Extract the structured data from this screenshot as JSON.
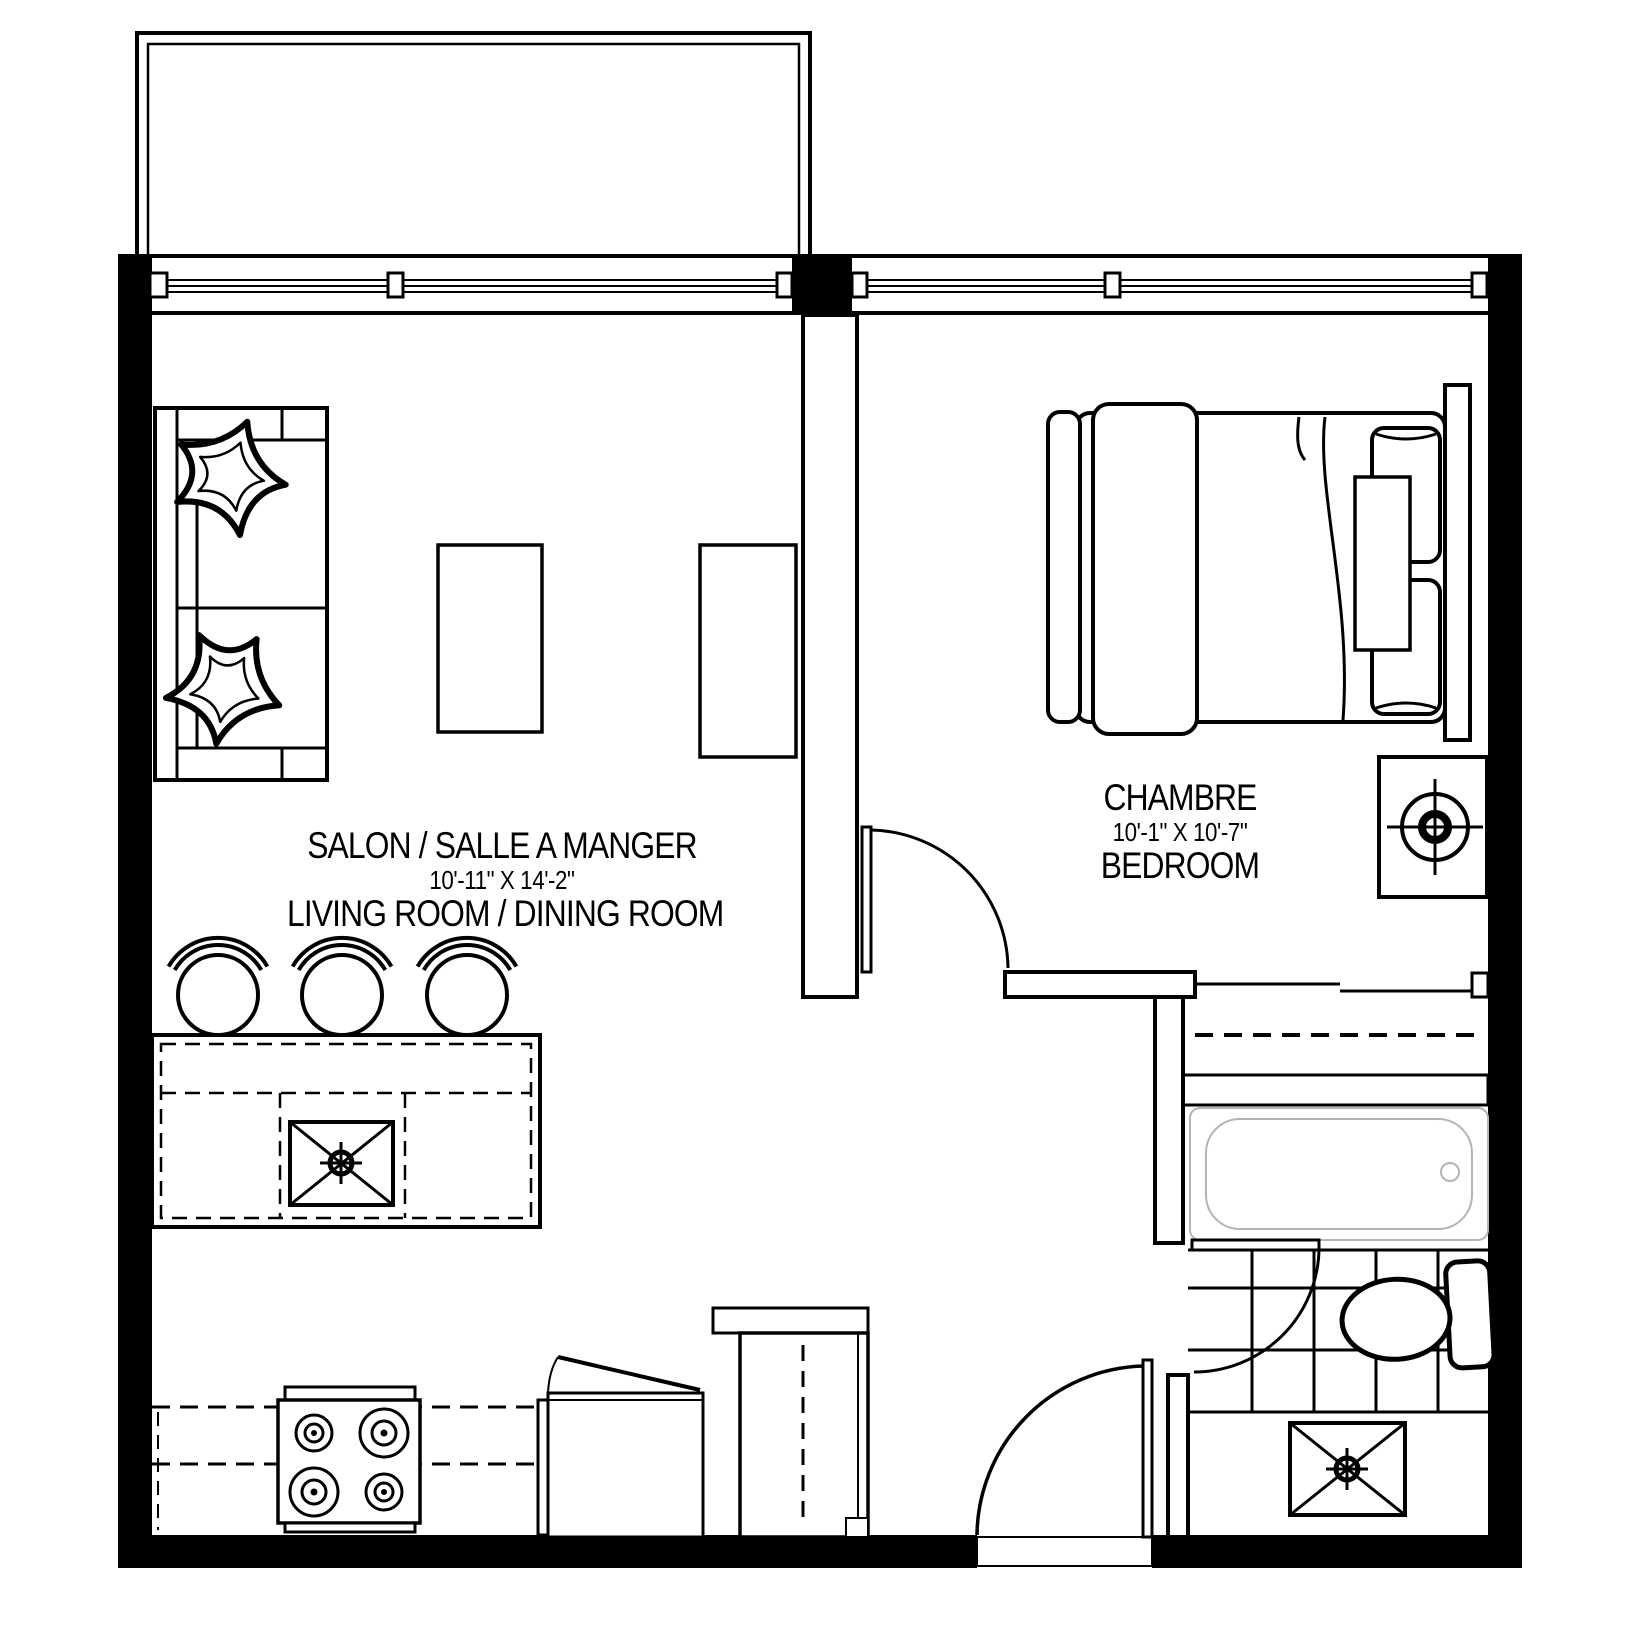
{
  "title": "One-bedroom apartment floor plan",
  "colors": {
    "ink": "#000000",
    "paper": "#ffffff",
    "tub_outline": "#b4b4b4"
  },
  "rooms": {
    "living_dining": {
      "label_fr": "SALON / SALLE A MANGER",
      "dimensions": "10'-11\" X 14'-2\"",
      "label_en": "LIVING ROOM  / DINING ROOM"
    },
    "bedroom": {
      "label_fr": "CHAMBRE",
      "dimensions": "10'-1\" X 10'-7\"",
      "label_en": "BEDROOM"
    }
  },
  "fixtures": [
    "balcony",
    "window-band",
    "sofa",
    "throw-pillows",
    "coffee-table",
    "tv-cabinet",
    "kitchen-island-with-sink",
    "bar-stools-x3",
    "range-4-burner",
    "kitchen-counter",
    "dishwasher-open-door",
    "refrigerator",
    "entry-door",
    "bedroom-door",
    "bathroom-door",
    "queen-bed",
    "nightstand-with-lamp",
    "closet-rod",
    "bathtub",
    "toilet",
    "vanity-sink",
    "tiled-bathroom-floor"
  ]
}
